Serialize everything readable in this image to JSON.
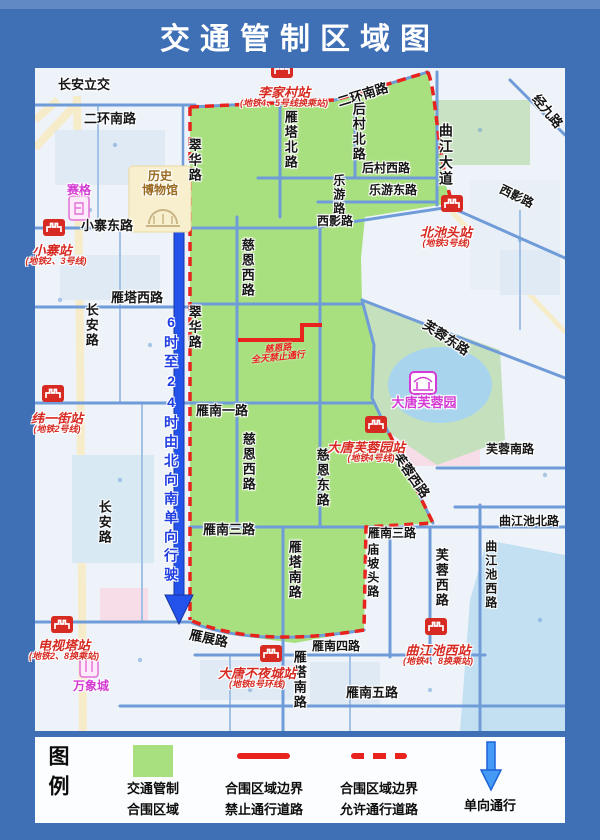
{
  "title": "交通管制区域图",
  "colors": {
    "frame": "#3f6fb5",
    "map_bg": "#eef3f9",
    "zone_green": "#a9e07f",
    "boundary_red": "#e8231e",
    "road_blue": "#6f9cd9",
    "arrow_blue": "#2353ea",
    "metro_red": "#d62a22",
    "poi_magenta": "#d43bd4",
    "museum_brown": "#9a6b21",
    "oneway_text": "#1f3de0",
    "legend_arrow": "#459af5"
  },
  "map": {
    "labels": {
      "changanlijiao": "长安立交",
      "erhuannanlu": "二环南路",
      "xiaozhaidonglu": "小寨东路",
      "yantaxilu": "雁塔西路",
      "houcunxilu": "后村西路",
      "leyoudonglu": "乐游东路",
      "xiyinglu": "西影路",
      "yannanyilu": "雁南一路",
      "yannansanlu": "雁南三路",
      "yannansilu": "雁南四路",
      "yannanwulu": "雁南五路",
      "qujiangchibeilu": "曲江池北路",
      "furongnanlu": "芙蓉南路",
      "yantabeilu": "雁塔北路",
      "houcunbeilu": "后村北路",
      "leyoulu": "乐游路",
      "cuihualu": "翠华路",
      "changanlu": "长安路",
      "cienxilu": "慈恩西路",
      "ciendonglu": "慈恩东路",
      "qujiangdadao": "曲江大道",
      "yantananlu": "雁塔南路",
      "miaopotoulu": "庙坡头路",
      "furongxilu": "芙蓉西路",
      "qujiangchixilu": "曲江池西路",
      "jingjiulu": "经九路",
      "furongdonglu": "芙蓉东路",
      "yanzhanlu": "雁展路"
    },
    "stations": {
      "lijiacun": {
        "name": "李家村站",
        "line": "(地铁4、5号线换乘站)"
      },
      "xiaozhai": {
        "name": "小寨站",
        "line": "(地铁2、3号线)"
      },
      "beichitou": {
        "name": "北池头站",
        "line": "(地铁3号线)"
      },
      "weiyijie": {
        "name": "纬一街站",
        "line": "(地铁2号线)"
      },
      "datangfurongyuan": {
        "name": "大唐芙蓉园站",
        "line": "(地铁4号线)"
      },
      "dianshita": {
        "name": "电视塔站",
        "line": "(地铁2、8换乘站)"
      },
      "datangbuyecheng": {
        "name": "大唐不夜城站",
        "line": "(地铁8号环线)"
      },
      "qujiangchixi": {
        "name": "曲江池西站",
        "line": "(地铁4、8换乘站)"
      }
    },
    "pois": {
      "saige": "赛格",
      "museum_line1": "历史",
      "museum_line2": "博物馆",
      "datangfurongyuan": "大唐芙蓉园",
      "wanxiangcheng": "万象城"
    },
    "restriction": {
      "road": "慈恩路",
      "note": "全天禁止通行"
    },
    "oneway_note": "6时至24时由北向南单向行驶"
  },
  "legend": {
    "heading": "图例",
    "zone_line1": "交通管制",
    "zone_line2": "合围区域",
    "closed_line1": "合围区域边界",
    "closed_line2": "禁止通行道路",
    "open_line1": "合围区域边界",
    "open_line2": "允许通行道路",
    "oneway": "单向通行"
  }
}
